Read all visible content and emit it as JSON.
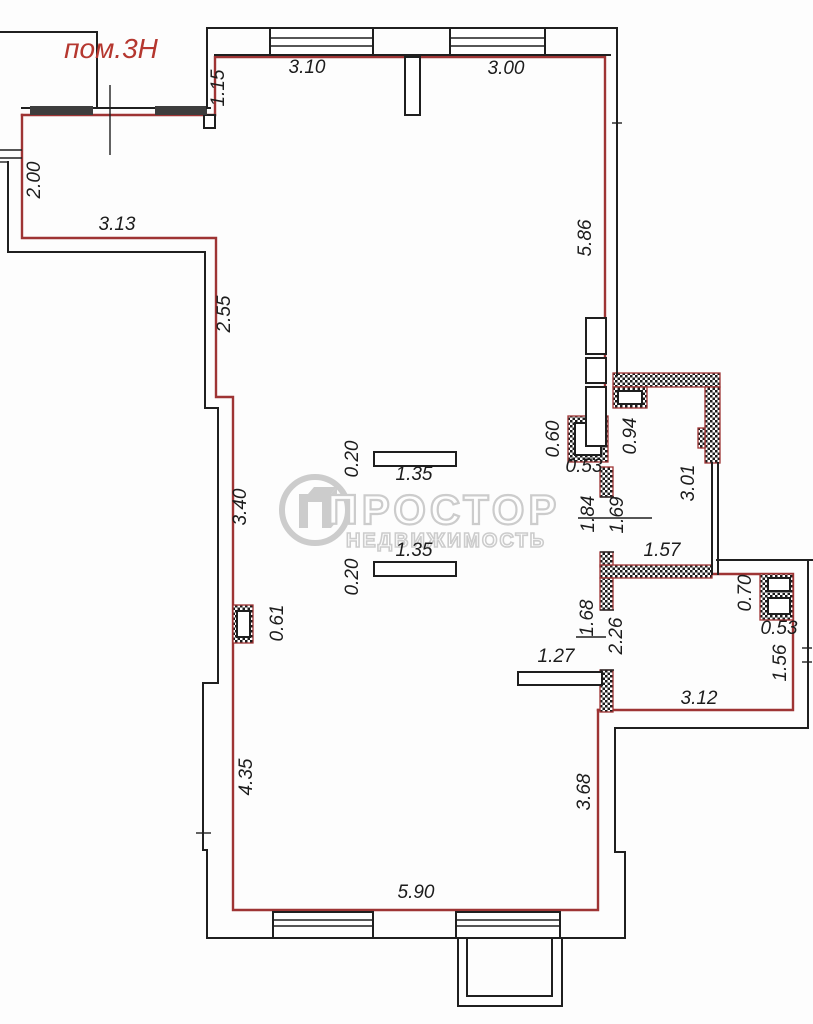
{
  "room_label": "пом.3Н",
  "watermark": {
    "brand": "ПРОСТОР",
    "subtitle": "НЕДВИЖИМОСТЬ"
  },
  "colors": {
    "wall_red": "#9e3434",
    "line_black": "#1f1f1f",
    "label_red": "#b5372f",
    "watermark_gray": "#c4c4c4",
    "background": "#fdfdfd"
  },
  "dimensions": [
    {
      "value": "1.15",
      "x": 224,
      "y": 88,
      "rot": -90
    },
    {
      "value": "3.10",
      "x": 307,
      "y": 73,
      "rot": 0
    },
    {
      "value": "3.00",
      "x": 506,
      "y": 74,
      "rot": 0
    },
    {
      "value": "2.00",
      "x": 40,
      "y": 180,
      "rot": -90
    },
    {
      "value": "3.13",
      "x": 117,
      "y": 230,
      "rot": 0
    },
    {
      "value": "5.86",
      "x": 591,
      "y": 238,
      "rot": -90
    },
    {
      "value": "2.55",
      "x": 230,
      "y": 314,
      "rot": -90
    },
    {
      "value": "3.40",
      "x": 246,
      "y": 507,
      "rot": -90
    },
    {
      "value": "0.20",
      "x": 358,
      "y": 459,
      "rot": -90
    },
    {
      "value": "1.35",
      "x": 414,
      "y": 480,
      "rot": 0
    },
    {
      "value": "1.35",
      "x": 414,
      "y": 556,
      "rot": 0
    },
    {
      "value": "0.20",
      "x": 358,
      "y": 577,
      "rot": -90
    },
    {
      "value": "0.60",
      "x": 559,
      "y": 439,
      "rot": -90
    },
    {
      "value": "0.53",
      "x": 584,
      "y": 472,
      "rot": 0
    },
    {
      "value": "0.94",
      "x": 636,
      "y": 436,
      "rot": -90
    },
    {
      "value": "3.01",
      "x": 694,
      "y": 483,
      "rot": -90
    },
    {
      "value": "1.84",
      "x": 594,
      "y": 514,
      "rot": -90
    },
    {
      "value": "1.69",
      "x": 623,
      "y": 515,
      "rot": -90
    },
    {
      "value": "1.57",
      "x": 662,
      "y": 556,
      "rot": 0
    },
    {
      "value": "0.61",
      "x": 283,
      "y": 623,
      "rot": -90
    },
    {
      "value": "1.68",
      "x": 593,
      "y": 618,
      "rot": -90
    },
    {
      "value": "2.26",
      "x": 622,
      "y": 636,
      "rot": -90
    },
    {
      "value": "1.27",
      "x": 556,
      "y": 662,
      "rot": 0
    },
    {
      "value": "0.70",
      "x": 751,
      "y": 593,
      "rot": -90
    },
    {
      "value": "0.53",
      "x": 779,
      "y": 634,
      "rot": 0
    },
    {
      "value": "1.56",
      "x": 786,
      "y": 663,
      "rot": -90
    },
    {
      "value": "3.12",
      "x": 699,
      "y": 704,
      "rot": 0
    },
    {
      "value": "4.35",
      "x": 252,
      "y": 777,
      "rot": -90
    },
    {
      "value": "3.68",
      "x": 590,
      "y": 792,
      "rot": -90
    },
    {
      "value": "5.90",
      "x": 416,
      "y": 898,
      "rot": 0
    }
  ]
}
